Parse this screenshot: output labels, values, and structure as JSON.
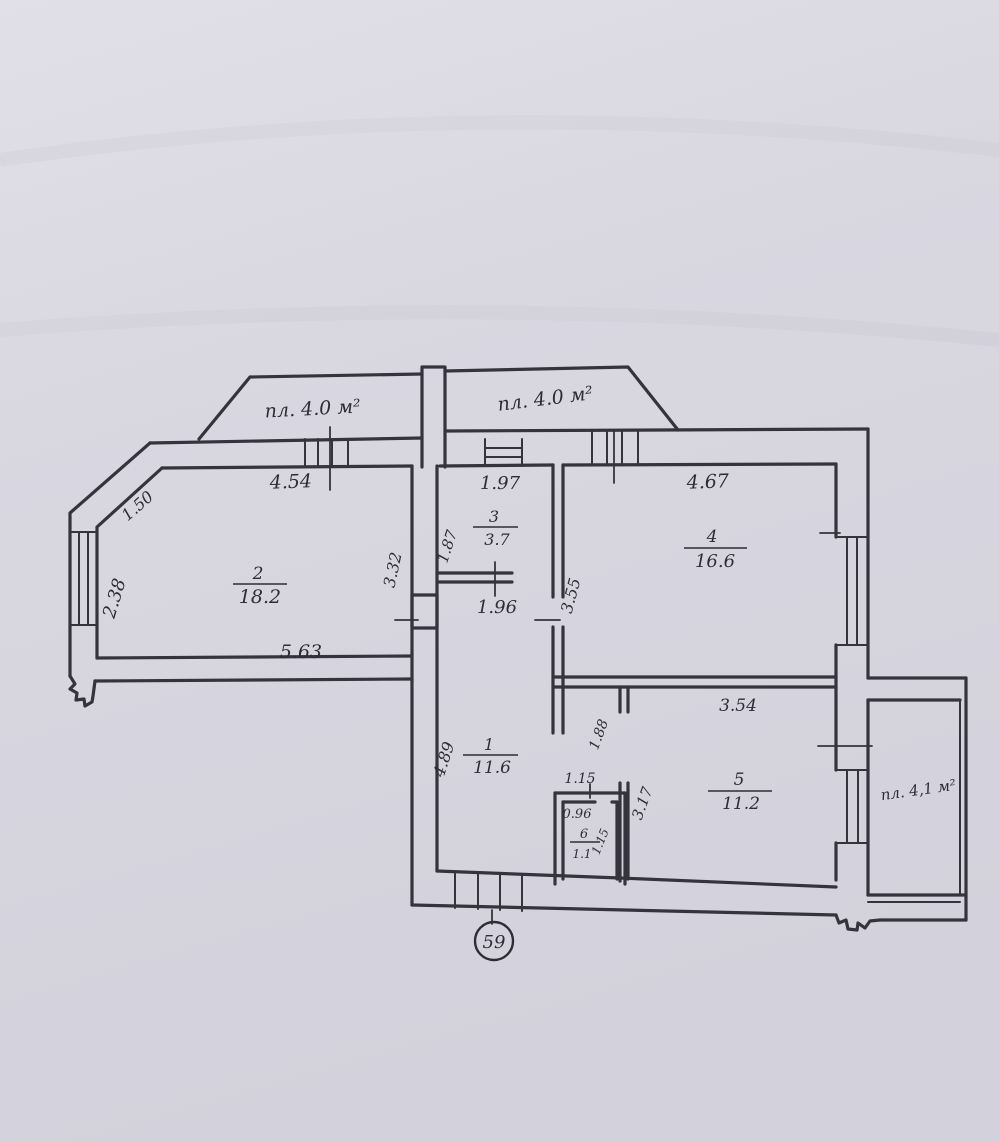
{
  "plan": {
    "apartment_number": "59",
    "balconies": {
      "top_left": "пл. 4.0 м²",
      "top_right": "пл. 4.0 м²",
      "right": "пл. 4,1 м²"
    },
    "rooms": {
      "r1": {
        "number": "1",
        "area": "11.6"
      },
      "r2": {
        "number": "2",
        "area": "18.2"
      },
      "r3": {
        "number": "3",
        "area": "3.7"
      },
      "r4": {
        "number": "4",
        "area": "16.6"
      },
      "r5": {
        "number": "5",
        "area": "11.2"
      },
      "r6": {
        "number": "6",
        "area": "1.1"
      }
    },
    "dimensions": {
      "top_left_wall": "4.54",
      "corridor_top": "1.97",
      "room4_top": "4.67",
      "corner_diagonal": "1.50",
      "left_wall": "2.38",
      "room2_right": "3.32",
      "room3_left": "1.87",
      "room4_left": "3.55",
      "room2_bottom": "5.63",
      "corridor_width": "1.96",
      "corridor_height": "4.89",
      "room5_door_offset": "1.88",
      "room5_top": "3.54",
      "room5_left": "3.17",
      "bath_nook_width": "1.15",
      "bath_inner_width": "0.96",
      "bath_inner_height": "1.15"
    },
    "colors": {
      "ink": "#35333b",
      "paper": "#d9d7e0"
    }
  }
}
